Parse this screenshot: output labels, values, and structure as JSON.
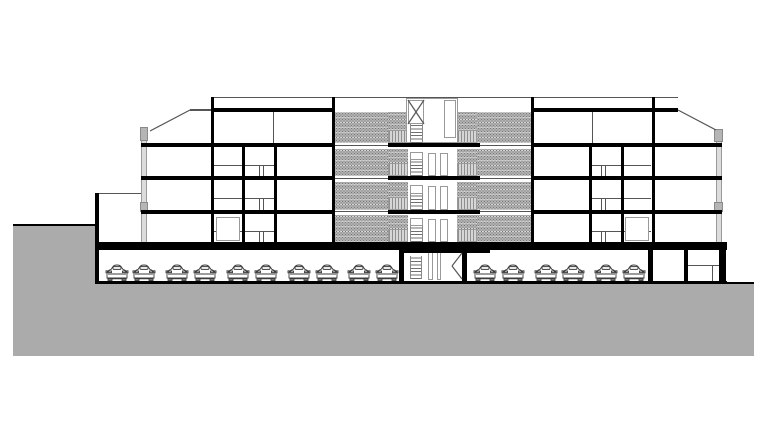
{
  "drawing": {
    "type": "architectural-section-elevation",
    "description": "Black-and-white cross-section of a four-storey apartment building with a central stair tower, dot-hatched access-gallery facade, glazed end walls, a semi-buried parking level with parked cars, and a grey sloping terrain mass",
    "visible_text": [],
    "colors": {
      "background": "#ffffff",
      "ink": "#000000",
      "terrain": "#ababab",
      "hatch_base": "#b2b2b2",
      "hatch_dot": "#787878",
      "railing_light": "#d6d6d6",
      "railing_dark": "#8f8f8f",
      "glazing": "#dcdcdc",
      "spandrel": "#b5b5b5",
      "thin_line": "#555555"
    },
    "counts": {
      "storeys_above_ground": 4,
      "parking_levels": 1,
      "cars_total": 16
    },
    "rects": [
      [
        13,
        226,
        82,
        58,
        "ter",
        "terrain-left-plateau"
      ],
      [
        13,
        284,
        741,
        72,
        "ter",
        "terrain-mass"
      ],
      [
        335,
        112,
        53,
        31,
        "hatch",
        "gallery-hatch-f4-left"
      ],
      [
        477,
        112,
        54,
        31,
        "hatch",
        "gallery-hatch-f4-right"
      ],
      [
        388,
        112,
        18,
        18,
        "hatch",
        "gallery-hatch-f4-left-top"
      ],
      [
        458,
        112,
        19,
        18,
        "hatch",
        "gallery-hatch-f4-right-top"
      ],
      [
        335,
        149,
        53,
        27,
        "hatch",
        "gallery-hatch-f3-left"
      ],
      [
        477,
        149,
        54,
        27,
        "hatch",
        "gallery-hatch-f3-right"
      ],
      [
        388,
        149,
        20,
        14,
        "hatch",
        "gallery-hatch-f3-left-top"
      ],
      [
        457,
        149,
        20,
        14,
        "hatch",
        "gallery-hatch-f3-right-top"
      ],
      [
        335,
        182,
        53,
        28,
        "hatch",
        "gallery-hatch-f2-left"
      ],
      [
        477,
        182,
        54,
        28,
        "hatch",
        "gallery-hatch-f2-right"
      ],
      [
        388,
        182,
        20,
        15,
        "hatch",
        "gallery-hatch-f2-left-top"
      ],
      [
        457,
        182,
        20,
        15,
        "hatch",
        "gallery-hatch-f2-right-top"
      ],
      [
        335,
        215,
        53,
        27,
        "hatch",
        "gallery-hatch-f1-left"
      ],
      [
        477,
        215,
        54,
        27,
        "hatch",
        "gallery-hatch-f1-right"
      ],
      [
        388,
        215,
        20,
        14,
        "hatch",
        "gallery-hatch-f1-left-top"
      ],
      [
        457,
        215,
        20,
        14,
        "hatch",
        "gallery-hatch-f1-right-top"
      ],
      [
        388,
        130,
        20,
        13,
        "rail",
        "balcony-railing-f4-left"
      ],
      [
        457,
        130,
        20,
        13,
        "rail",
        "balcony-railing-f4-right"
      ],
      [
        388,
        163,
        20,
        13,
        "rail",
        "balcony-railing-f3-left"
      ],
      [
        457,
        163,
        20,
        13,
        "rail",
        "balcony-railing-f3-right"
      ],
      [
        388,
        197,
        20,
        13,
        "rail",
        "balcony-railing-f2-left"
      ],
      [
        457,
        197,
        20,
        13,
        "rail",
        "balcony-railing-f2-right"
      ],
      [
        388,
        229,
        20,
        13,
        "rail",
        "balcony-railing-f1-left"
      ],
      [
        457,
        229,
        20,
        13,
        "rail",
        "balcony-railing-f1-right"
      ],
      [
        141,
        127,
        6,
        116,
        "glz",
        "facade-glazing-left"
      ],
      [
        716,
        130,
        6,
        112,
        "glz",
        "facade-glazing-right"
      ],
      [
        140,
        127,
        8,
        14,
        "blk",
        "parapet-block-left"
      ],
      [
        140,
        202,
        8,
        10,
        "blk",
        "spandrel-block-left"
      ],
      [
        714,
        129,
        9,
        13,
        "blk",
        "parapet-block-right"
      ],
      [
        714,
        202,
        9,
        10,
        "blk",
        "spandrel-block-right"
      ],
      [
        212,
        97,
        466,
        1,
        "ln",
        "parapet-line"
      ],
      [
        190,
        109,
        22,
        2,
        "ln",
        "roof-edge-left"
      ],
      [
        99,
        193,
        42,
        1,
        "ln",
        "annex-roof-line"
      ],
      [
        335,
        145,
        53,
        1,
        "ln",
        "gallery-slab-line-4a"
      ],
      [
        480,
        145,
        51,
        1,
        "ln",
        "gallery-slab-line-4b"
      ],
      [
        335,
        178,
        53,
        1,
        "ln",
        "gallery-slab-line-3a"
      ],
      [
        480,
        178,
        51,
        1,
        "ln",
        "gallery-slab-line-3b"
      ],
      [
        335,
        211,
        53,
        1,
        "ln",
        "gallery-slab-line-2a"
      ],
      [
        480,
        211,
        51,
        1,
        "ln",
        "gallery-slab-line-2b"
      ],
      [
        688,
        265,
        31,
        1,
        "ln",
        "storage-shelf-line"
      ],
      [
        712,
        266,
        1,
        16,
        "ln",
        "storage-divider-line"
      ],
      [
        273,
        112,
        1,
        31,
        "ln",
        "attic-mullion-left"
      ],
      [
        592,
        112,
        1,
        31,
        "ln",
        "attic-mullion-right"
      ],
      [
        425,
        100,
        1,
        28,
        "ln",
        "penthouse-mullion"
      ],
      [
        426,
        103,
        31,
        1,
        "ln",
        "penthouse-shade-line-a"
      ],
      [
        426,
        105,
        31,
        1,
        "ln",
        "penthouse-shade-line-b"
      ],
      [
        213,
        165,
        62,
        1,
        "ln",
        "door-head-left-f3"
      ],
      [
        259,
        166,
        1,
        10,
        "ln",
        "door-jamb-left-f3a"
      ],
      [
        263,
        166,
        1,
        10,
        "ln",
        "door-jamb-left-f3b"
      ],
      [
        213,
        198,
        62,
        1,
        "ln",
        "door-head-left-f2"
      ],
      [
        259,
        199,
        1,
        11,
        "ln",
        "door-jamb-left-f2a"
      ],
      [
        263,
        199,
        1,
        11,
        "ln",
        "door-jamb-left-f2b"
      ],
      [
        213,
        231,
        62,
        1,
        "ln",
        "door-head-left-f1"
      ],
      [
        259,
        232,
        1,
        10,
        "ln",
        "door-jamb-left-f1a"
      ],
      [
        263,
        232,
        1,
        10,
        "ln",
        "door-jamb-left-f1b"
      ],
      [
        589,
        165,
        62,
        1,
        "ln",
        "door-head-right-f3"
      ],
      [
        601,
        166,
        1,
        10,
        "ln",
        "door-jamb-right-f3a"
      ],
      [
        605,
        166,
        1,
        10,
        "ln",
        "door-jamb-right-f3b"
      ],
      [
        589,
        198,
        62,
        1,
        "ln",
        "door-head-right-f2"
      ],
      [
        601,
        199,
        1,
        11,
        "ln",
        "door-jamb-right-f2a"
      ],
      [
        605,
        199,
        1,
        11,
        "ln",
        "door-jamb-right-f2b"
      ],
      [
        589,
        231,
        62,
        1,
        "ln",
        "door-head-right-f1"
      ],
      [
        601,
        232,
        1,
        10,
        "ln",
        "door-jamb-right-f1a"
      ],
      [
        605,
        232,
        1,
        10,
        "ln",
        "door-jamb-right-f1b"
      ],
      [
        406,
        98,
        52,
        45,
        "thin",
        "stair-tower-penthouse"
      ],
      [
        408,
        100,
        16,
        24,
        "thin",
        "roof-hatch-panel"
      ],
      [
        444,
        100,
        12,
        38,
        "thin",
        "penthouse-door"
      ],
      [
        410,
        152,
        13,
        8,
        "thin",
        "stair-landing-door-f3"
      ],
      [
        428,
        153,
        8,
        23,
        "thin",
        "tower-door-f3a"
      ],
      [
        440,
        153,
        8,
        23,
        "thin",
        "tower-door-f3b"
      ],
      [
        410,
        185,
        13,
        9,
        "thin",
        "stair-landing-door-f2"
      ],
      [
        428,
        186,
        8,
        24,
        "thin",
        "tower-door-f2a"
      ],
      [
        440,
        186,
        8,
        24,
        "thin",
        "tower-door-f2b"
      ],
      [
        410,
        218,
        13,
        8,
        "thin",
        "stair-landing-door-f1"
      ],
      [
        428,
        219,
        8,
        23,
        "thin",
        "tower-door-f1a"
      ],
      [
        440,
        219,
        8,
        23,
        "thin",
        "tower-door-f1b"
      ],
      [
        428,
        252,
        5,
        28,
        "thin",
        "tower-door-parking-a"
      ],
      [
        437,
        252,
        4,
        28,
        "thin",
        "tower-door-parking-b"
      ],
      [
        216,
        217,
        24,
        24,
        "thin",
        "entry-door-left-wing"
      ],
      [
        625,
        217,
        24,
        24,
        "thin",
        "entry-door-right-wing"
      ],
      [
        410,
        124,
        13,
        19,
        "stair",
        "stair-run-f4"
      ],
      [
        410,
        160,
        13,
        16,
        "stair",
        "stair-run-f3"
      ],
      [
        410,
        194,
        13,
        16,
        "stair",
        "stair-run-f2"
      ],
      [
        410,
        226,
        13,
        16,
        "stair",
        "stair-run-f1"
      ],
      [
        410,
        256,
        12,
        23,
        "stair",
        "stair-run-parking"
      ],
      [
        211,
        108,
        124,
        4,
        "k",
        "top-fascia-left"
      ],
      [
        532,
        108,
        146,
        4,
        "k",
        "top-fascia-right"
      ],
      [
        141,
        143,
        194,
        4,
        "k",
        "slab-f4-left-wing"
      ],
      [
        388,
        143,
        92,
        4,
        "k",
        "slab-f4-center"
      ],
      [
        531,
        143,
        191,
        4,
        "k",
        "slab-f4-right-wing"
      ],
      [
        141,
        176,
        194,
        4,
        "k",
        "slab-f3-left-wing"
      ],
      [
        388,
        176,
        92,
        4,
        "k",
        "slab-f3-center"
      ],
      [
        531,
        176,
        191,
        4,
        "k",
        "slab-f3-right-wing"
      ],
      [
        141,
        210,
        194,
        4,
        "k",
        "slab-f2-left-wing"
      ],
      [
        388,
        210,
        92,
        4,
        "k",
        "slab-f2-center"
      ],
      [
        531,
        210,
        191,
        4,
        "k",
        "slab-f2-right-wing"
      ],
      [
        95,
        242,
        632,
        8,
        "k",
        "ground-floor-slab"
      ],
      [
        402,
        250,
        88,
        3,
        "k",
        "tower-slab-step"
      ],
      [
        95,
        281,
        632,
        3,
        "k",
        "parking-floor-slab"
      ],
      [
        727,
        282,
        27,
        2,
        "k",
        "grade-line-right"
      ],
      [
        13,
        224,
        83,
        2,
        "k",
        "grade-line-left"
      ],
      [
        211,
        97,
        3,
        146,
        "k",
        "wall-left-inner"
      ],
      [
        242,
        147,
        3,
        95,
        "k",
        "wall-left-mid-a"
      ],
      [
        274,
        147,
        3,
        95,
        "k",
        "wall-left-mid-b"
      ],
      [
        332,
        97,
        3,
        145,
        "k",
        "wall-gallery-left"
      ],
      [
        531,
        97,
        3,
        145,
        "k",
        "wall-gallery-right"
      ],
      [
        589,
        147,
        3,
        95,
        "k",
        "wall-right-mid-a"
      ],
      [
        621,
        147,
        3,
        95,
        "k",
        "wall-right-mid-b"
      ],
      [
        652,
        97,
        3,
        146,
        "k",
        "wall-right-inner"
      ],
      [
        95,
        193,
        4,
        89,
        "k",
        "annex-retaining-wall"
      ],
      [
        399,
        250,
        5,
        31,
        "k",
        "tower-wall-left-parking"
      ],
      [
        462,
        250,
        5,
        31,
        "k",
        "tower-wall-right-parking"
      ],
      [
        648,
        250,
        5,
        31,
        "k",
        "storage-wall-a"
      ],
      [
        684,
        250,
        4,
        31,
        "k",
        "storage-wall-b"
      ],
      [
        719,
        250,
        7,
        32,
        "k",
        "parking-wall-right"
      ]
    ],
    "lines": [
      [
        150,
        131,
        190,
        110,
        "roof-slope-left"
      ],
      [
        678,
        110,
        716,
        130,
        "roof-slope-right"
      ],
      [
        408,
        100,
        424,
        124,
        "roof-hatch-diagonal-a"
      ],
      [
        424,
        100,
        408,
        124,
        "roof-hatch-diagonal-b"
      ],
      [
        462,
        253,
        452,
        266,
        "parking-door-leaf-a"
      ],
      [
        452,
        266,
        462,
        279,
        "parking-door-leaf-b"
      ]
    ],
    "cars": {
      "left_row_x": [
        117,
        144,
        177,
        205,
        238,
        266,
        299,
        327,
        359,
        387
      ],
      "right_row_x": [
        485,
        513,
        546,
        573,
        606,
        634
      ],
      "bottom_y": 281,
      "width": 24,
      "height": 19
    }
  }
}
